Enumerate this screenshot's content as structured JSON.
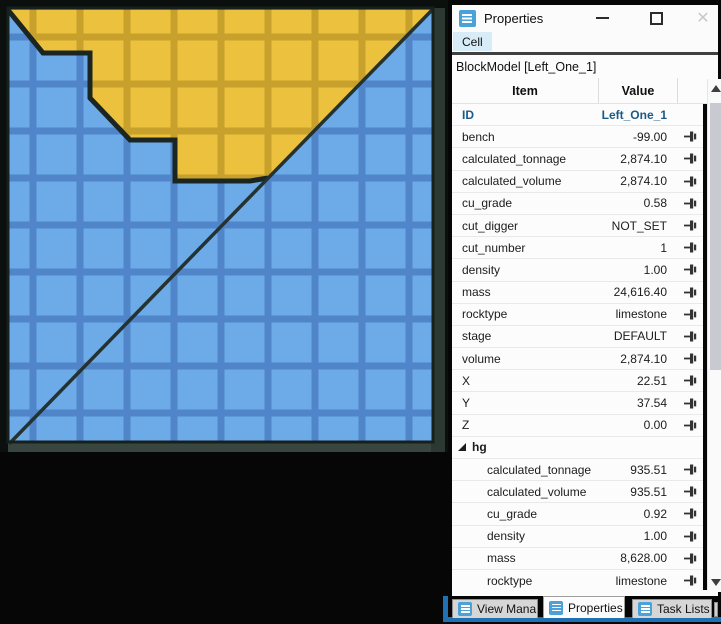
{
  "window": {
    "title": "Properties",
    "close_glyph": "✕"
  },
  "menubar": {
    "items": [
      {
        "label": "Cell"
      }
    ]
  },
  "properties_panel": {
    "header": "BlockModel [Left_One_1]",
    "columns": {
      "item": "Item",
      "value": "Value"
    },
    "rows": [
      {
        "label": "ID",
        "value": "Left_One_1",
        "style": "id",
        "pin": false
      },
      {
        "label": "bench",
        "value": "-99.00",
        "style": "normal",
        "pin": true
      },
      {
        "label": "calculated_tonnage",
        "value": "2,874.10",
        "style": "normal",
        "pin": true
      },
      {
        "label": "calculated_volume",
        "value": "2,874.10",
        "style": "normal",
        "pin": true
      },
      {
        "label": "cu_grade",
        "value": "0.58",
        "style": "normal",
        "pin": true
      },
      {
        "label": "cut_digger",
        "value": "NOT_SET",
        "style": "normal",
        "pin": true
      },
      {
        "label": "cut_number",
        "value": "1",
        "style": "normal",
        "pin": true
      },
      {
        "label": "density",
        "value": "1.00",
        "style": "normal",
        "pin": true
      },
      {
        "label": "mass",
        "value": "24,616.40",
        "style": "normal",
        "pin": true
      },
      {
        "label": "rocktype",
        "value": "limestone",
        "style": "normal",
        "pin": true
      },
      {
        "label": "stage",
        "value": "DEFAULT",
        "style": "normal",
        "pin": true
      },
      {
        "label": "volume",
        "value": "2,874.10",
        "style": "normal",
        "pin": true
      },
      {
        "label": "X",
        "value": "22.51",
        "style": "normal",
        "pin": true
      },
      {
        "label": "Y",
        "value": "37.54",
        "style": "normal",
        "pin": true
      },
      {
        "label": "Z",
        "value": "0.00",
        "style": "normal",
        "pin": true
      },
      {
        "label": "hg",
        "value": "",
        "style": "group",
        "pin": false
      },
      {
        "label": "calculated_tonnage",
        "value": "935.51",
        "style": "child",
        "pin": true
      },
      {
        "label": "calculated_volume",
        "value": "935.51",
        "style": "child",
        "pin": true
      },
      {
        "label": "cu_grade",
        "value": "0.92",
        "style": "child",
        "pin": true
      },
      {
        "label": "density",
        "value": "1.00",
        "style": "child",
        "pin": true
      },
      {
        "label": "mass",
        "value": "8,628.00",
        "style": "child",
        "pin": true
      },
      {
        "label": "rocktype",
        "value": "limestone",
        "style": "child",
        "pin": true
      }
    ]
  },
  "bottom_tabs": {
    "tabs": [
      {
        "label": "View Mana",
        "active": false
      },
      {
        "label": "Properties",
        "active": true
      },
      {
        "label": "Task Lists",
        "active": false
      }
    ],
    "accent_color": "#2070b4"
  },
  "viz": {
    "kind": "block-model-cross-section",
    "cell_size": 47,
    "line_width": 7,
    "blue_cell": "#6cabe8",
    "blue_line": "#5086c9",
    "yellow_cell": "#ecc13d",
    "yellow_line": "#c7a12c",
    "outline": "#1b2622",
    "frame_dark": "#0b100e",
    "frame_band_bottom": "#39463f",
    "frame_band_right": "#2c3832",
    "grid": {
      "x": 8,
      "y": 8,
      "w": 425,
      "h": 434,
      "pattern_x": 29.5,
      "pattern_y": 33.5
    },
    "ore_polygon": "10,10 433,10 268,179 250,181 175,181 175,140 130,140 90,98 90,53 43,53",
    "terrain_line": "8,10 43,53 90,53 90,98 130,140 175,140 175,181 250,181 268,178",
    "diagonal": {
      "x1": 432,
      "y1": 10,
      "x2": 9,
      "y2": 444
    }
  }
}
